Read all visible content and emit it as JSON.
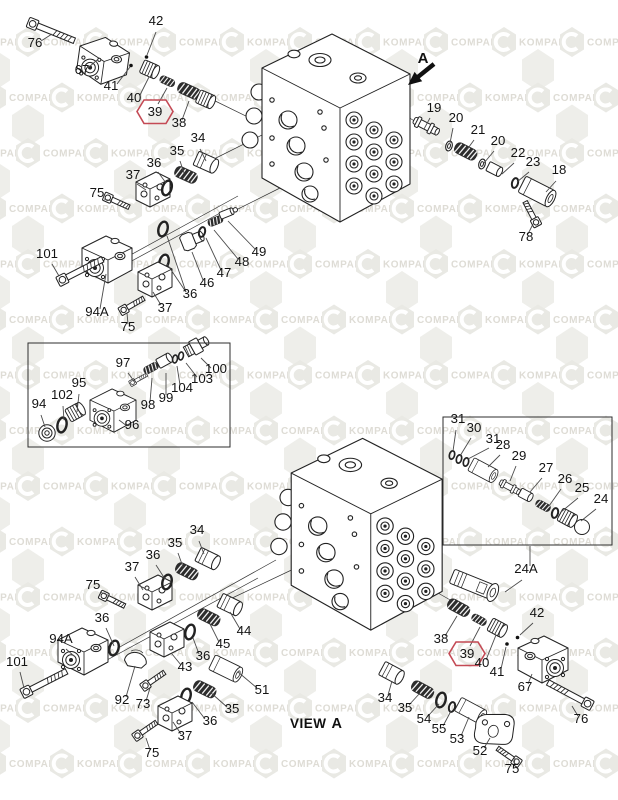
{
  "diagram": {
    "type": "exploded-parts-diagram",
    "view_label": {
      "prefix": "VIEW",
      "letter": "A"
    },
    "direction_arrow_label": "A",
    "highlight_color": "#c44a55",
    "line_color": "#4a4a4a",
    "watermark": {
      "words": [
        "KOMPART",
        "COMPART"
      ],
      "hex_fill": "#e9e9e4",
      "text_fill": "#dedcd5",
      "bg_hex_fill": "#eeeeea"
    },
    "inset_boxes": [
      {
        "x": 28,
        "y": 343,
        "w": 202,
        "h": 104
      },
      {
        "x": 443,
        "y": 417,
        "w": 169,
        "h": 128
      }
    ],
    "callouts": [
      {
        "n": "42",
        "x": 156,
        "y": 25,
        "l": [
          [
            156,
            32,
            147,
            55
          ]
        ]
      },
      {
        "n": "76",
        "x": 35,
        "y": 47,
        "l": [
          [
            41,
            41,
            52,
            34
          ]
        ]
      },
      {
        "n": "67",
        "x": 82,
        "y": 74,
        "l": [
          [
            88,
            68,
            97,
            60
          ]
        ]
      },
      {
        "n": "41",
        "x": 111,
        "y": 90,
        "l": [
          [
            117,
            84,
            130,
            67
          ]
        ]
      },
      {
        "n": "40",
        "x": 134,
        "y": 102,
        "l": [
          [
            140,
            95,
            149,
            77
          ]
        ]
      },
      {
        "n": "39",
        "x": 155,
        "y": 116,
        "h": true,
        "l": [
          [
            158,
            104,
            167,
            88
          ]
        ]
      },
      {
        "n": "38",
        "x": 179,
        "y": 127,
        "l": [
          [
            182,
            120,
            189,
            101
          ]
        ]
      },
      {
        "n": "34",
        "x": 198,
        "y": 142,
        "l": [
          [
            200,
            149,
            206,
            161
          ]
        ]
      },
      {
        "n": "35",
        "x": 177,
        "y": 155,
        "l": [
          [
            180,
            161,
            184,
            173
          ]
        ]
      },
      {
        "n": "36",
        "x": 154,
        "y": 167,
        "l": [
          [
            158,
            172,
            166,
            183
          ]
        ]
      },
      {
        "n": "37",
        "x": 133,
        "y": 179,
        "l": [
          [
            137,
            184,
            146,
            190
          ]
        ]
      },
      {
        "n": "75",
        "x": 97,
        "y": 197,
        "l": [
          [
            104,
            199,
            112,
            201
          ]
        ]
      },
      {
        "n": "101",
        "x": 47,
        "y": 258,
        "l": [
          [
            52,
            264,
            59,
            276
          ]
        ]
      },
      {
        "n": "94A",
        "x": 97,
        "y": 316,
        "l": [
          [
            100,
            309,
            106,
            274
          ]
        ]
      },
      {
        "n": "75",
        "x": 128,
        "y": 331,
        "l": [
          [
            128,
            324,
            127,
            313
          ]
        ]
      },
      {
        "n": "37",
        "x": 165,
        "y": 312,
        "l": [
          [
            161,
            305,
            153,
            292
          ]
        ]
      },
      {
        "n": "36",
        "x": 190,
        "y": 298,
        "l": [
          [
            186,
            292,
            167,
            236
          ],
          [
            186,
            292,
            167,
            264
          ]
        ]
      },
      {
        "n": "46",
        "x": 207,
        "y": 287,
        "l": [
          [
            203,
            280,
            192,
            252
          ]
        ]
      },
      {
        "n": "47",
        "x": 224,
        "y": 277,
        "l": [
          [
            221,
            270,
            206,
            238
          ]
        ]
      },
      {
        "n": "48",
        "x": 242,
        "y": 266,
        "l": [
          [
            238,
            259,
            214,
            230
          ]
        ]
      },
      {
        "n": "49",
        "x": 259,
        "y": 256,
        "l": [
          [
            255,
            249,
            228,
            221
          ]
        ]
      },
      {
        "n": "19",
        "x": 434,
        "y": 112,
        "l": [
          [
            430,
            118,
            424,
            129
          ]
        ]
      },
      {
        "n": "20",
        "x": 456,
        "y": 122,
        "l": [
          [
            453,
            128,
            450,
            143
          ]
        ]
      },
      {
        "n": "21",
        "x": 478,
        "y": 134,
        "l": [
          [
            474,
            140,
            466,
            151
          ]
        ]
      },
      {
        "n": "20",
        "x": 498,
        "y": 145,
        "l": [
          [
            494,
            151,
            484,
            163
          ]
        ]
      },
      {
        "n": "22",
        "x": 518,
        "y": 157,
        "l": [
          [
            514,
            163,
            502,
            174
          ]
        ]
      },
      {
        "n": "23",
        "x": 533,
        "y": 166,
        "l": [
          [
            529,
            172,
            517,
            182
          ]
        ]
      },
      {
        "n": "18",
        "x": 559,
        "y": 174,
        "l": [
          [
            556,
            181,
            546,
            192
          ]
        ]
      },
      {
        "n": "78",
        "x": 526,
        "y": 241,
        "l": [
          [
            528,
            234,
            533,
            224
          ]
        ]
      },
      {
        "n": "97",
        "x": 123,
        "y": 367,
        "l": [
          [
            128,
            373,
            134,
            381
          ]
        ]
      },
      {
        "n": "100",
        "x": 216,
        "y": 373,
        "l": [
          [
            211,
            368,
            201,
            358
          ]
        ]
      },
      {
        "n": "103",
        "x": 202,
        "y": 383,
        "l": [
          [
            197,
            377,
            186,
            363
          ]
        ]
      },
      {
        "n": "104",
        "x": 182,
        "y": 392,
        "l": [
          [
            180,
            385,
            177,
            366
          ]
        ]
      },
      {
        "n": "99",
        "x": 166,
        "y": 402,
        "l": [
          [
            166,
            395,
            166,
            373
          ]
        ]
      },
      {
        "n": "98",
        "x": 148,
        "y": 409,
        "l": [
          [
            150,
            402,
            152,
            378
          ]
        ]
      },
      {
        "n": "95",
        "x": 79,
        "y": 387,
        "l": [
          [
            79,
            394,
            77,
            412
          ]
        ]
      },
      {
        "n": "102",
        "x": 62,
        "y": 399,
        "l": [
          [
            63,
            406,
            64,
            420
          ]
        ]
      },
      {
        "n": "94",
        "x": 39,
        "y": 408,
        "l": [
          [
            41,
            415,
            45,
            427
          ]
        ]
      },
      {
        "n": "96",
        "x": 132,
        "y": 429,
        "l": [
          [
            127,
            426,
            119,
            420
          ]
        ]
      },
      {
        "n": "31",
        "x": 458,
        "y": 423,
        "l": [
          [
            456,
            430,
            453,
            451
          ]
        ]
      },
      {
        "n": "30",
        "x": 474,
        "y": 432,
        "l": [
          [
            471,
            438,
            460,
            456
          ]
        ]
      },
      {
        "n": "31",
        "x": 493,
        "y": 443,
        "l": [
          [
            489,
            448,
            468,
            459
          ]
        ]
      },
      {
        "n": "28",
        "x": 503,
        "y": 449,
        "l": [
          [
            500,
            455,
            488,
            467
          ]
        ]
      },
      {
        "n": "29",
        "x": 519,
        "y": 460,
        "l": [
          [
            516,
            466,
            510,
            481
          ]
        ]
      },
      {
        "n": "27",
        "x": 546,
        "y": 472,
        "l": [
          [
            542,
            478,
            530,
            492
          ]
        ]
      },
      {
        "n": "26",
        "x": 565,
        "y": 483,
        "l": [
          [
            561,
            489,
            549,
            506
          ]
        ]
      },
      {
        "n": "25",
        "x": 582,
        "y": 492,
        "l": [
          [
            578,
            498,
            561,
            512
          ]
        ]
      },
      {
        "n": "24",
        "x": 601,
        "y": 503,
        "l": [
          [
            596,
            509,
            581,
            521
          ]
        ]
      },
      {
        "n": "24A",
        "x": 526,
        "y": 573,
        "l": [
          [
            530,
            566,
            530,
            546
          ],
          [
            522,
            580,
            505,
            592
          ]
        ]
      },
      {
        "n": "34",
        "x": 197,
        "y": 534,
        "l": [
          [
            199,
            541,
            204,
            554
          ]
        ]
      },
      {
        "n": "35",
        "x": 175,
        "y": 547,
        "l": [
          [
            178,
            553,
            183,
            567
          ]
        ]
      },
      {
        "n": "36",
        "x": 153,
        "y": 559,
        "l": [
          [
            156,
            565,
            165,
            579
          ]
        ]
      },
      {
        "n": "37",
        "x": 132,
        "y": 571,
        "l": [
          [
            135,
            577,
            143,
            590
          ]
        ]
      },
      {
        "n": "75",
        "x": 93,
        "y": 589,
        "l": [
          [
            100,
            592,
            110,
            596
          ]
        ]
      },
      {
        "n": "36",
        "x": 102,
        "y": 622,
        "l": [
          [
            106,
            628,
            114,
            646
          ]
        ]
      },
      {
        "n": "94A",
        "x": 61,
        "y": 643,
        "l": [
          [
            66,
            649,
            74,
            656
          ]
        ]
      },
      {
        "n": "101",
        "x": 17,
        "y": 666,
        "l": [
          [
            20,
            672,
            24,
            688
          ]
        ]
      },
      {
        "n": "92",
        "x": 122,
        "y": 704,
        "l": [
          [
            126,
            697,
            135,
            666
          ]
        ]
      },
      {
        "n": "73",
        "x": 143,
        "y": 708,
        "l": [
          [
            146,
            701,
            150,
            688
          ]
        ]
      },
      {
        "n": "43",
        "x": 185,
        "y": 671,
        "l": [
          [
            181,
            665,
            172,
            654
          ]
        ]
      },
      {
        "n": "36",
        "x": 203,
        "y": 660,
        "l": [
          [
            199,
            654,
            193,
            638
          ]
        ]
      },
      {
        "n": "45",
        "x": 223,
        "y": 648,
        "l": [
          [
            219,
            642,
            210,
            624
          ]
        ]
      },
      {
        "n": "44",
        "x": 244,
        "y": 635,
        "l": [
          [
            240,
            629,
            230,
            612
          ]
        ]
      },
      {
        "n": "51",
        "x": 262,
        "y": 694,
        "l": [
          [
            257,
            688,
            238,
            672
          ]
        ]
      },
      {
        "n": "35",
        "x": 232,
        "y": 713,
        "l": [
          [
            227,
            707,
            210,
            692
          ]
        ]
      },
      {
        "n": "36",
        "x": 210,
        "y": 725,
        "l": [
          [
            205,
            719,
            192,
            702
          ]
        ]
      },
      {
        "n": "37",
        "x": 185,
        "y": 740,
        "l": [
          [
            181,
            734,
            173,
            722
          ]
        ]
      },
      {
        "n": "75",
        "x": 152,
        "y": 757,
        "l": [
          [
            150,
            750,
            146,
            738
          ]
        ]
      },
      {
        "n": "38",
        "x": 441,
        "y": 643,
        "l": [
          [
            445,
            636,
            457,
            616
          ]
        ]
      },
      {
        "n": "39",
        "x": 467,
        "y": 658,
        "h": true,
        "l": [
          [
            470,
            646,
            480,
            627
          ]
        ]
      },
      {
        "n": "40",
        "x": 482,
        "y": 667,
        "l": [
          [
            486,
            660,
            496,
            635
          ]
        ]
      },
      {
        "n": "41",
        "x": 497,
        "y": 676,
        "l": [
          [
            501,
            669,
            506,
            647
          ]
        ]
      },
      {
        "n": "42",
        "x": 537,
        "y": 617,
        "l": [
          [
            533,
            623,
            520,
            635
          ]
        ]
      },
      {
        "n": "67",
        "x": 525,
        "y": 691,
        "l": [
          [
            528,
            684,
            532,
            674
          ]
        ]
      },
      {
        "n": "76",
        "x": 581,
        "y": 723,
        "l": [
          [
            578,
            716,
            572,
            706
          ]
        ]
      },
      {
        "n": "34",
        "x": 385,
        "y": 702,
        "l": [
          [
            388,
            695,
            392,
            681
          ]
        ]
      },
      {
        "n": "35",
        "x": 405,
        "y": 712,
        "l": [
          [
            409,
            705,
            420,
            693
          ]
        ]
      },
      {
        "n": "54",
        "x": 424,
        "y": 723,
        "l": [
          [
            428,
            716,
            439,
            704
          ]
        ]
      },
      {
        "n": "55",
        "x": 439,
        "y": 733,
        "l": [
          [
            443,
            726,
            451,
            711
          ]
        ]
      },
      {
        "n": "53",
        "x": 457,
        "y": 743,
        "l": [
          [
            461,
            736,
            469,
            717
          ]
        ]
      },
      {
        "n": "52",
        "x": 480,
        "y": 755,
        "l": [
          [
            484,
            748,
            490,
            738
          ]
        ]
      },
      {
        "n": "75",
        "x": 512,
        "y": 773,
        "l": [
          [
            514,
            766,
            515,
            758
          ]
        ]
      }
    ]
  }
}
